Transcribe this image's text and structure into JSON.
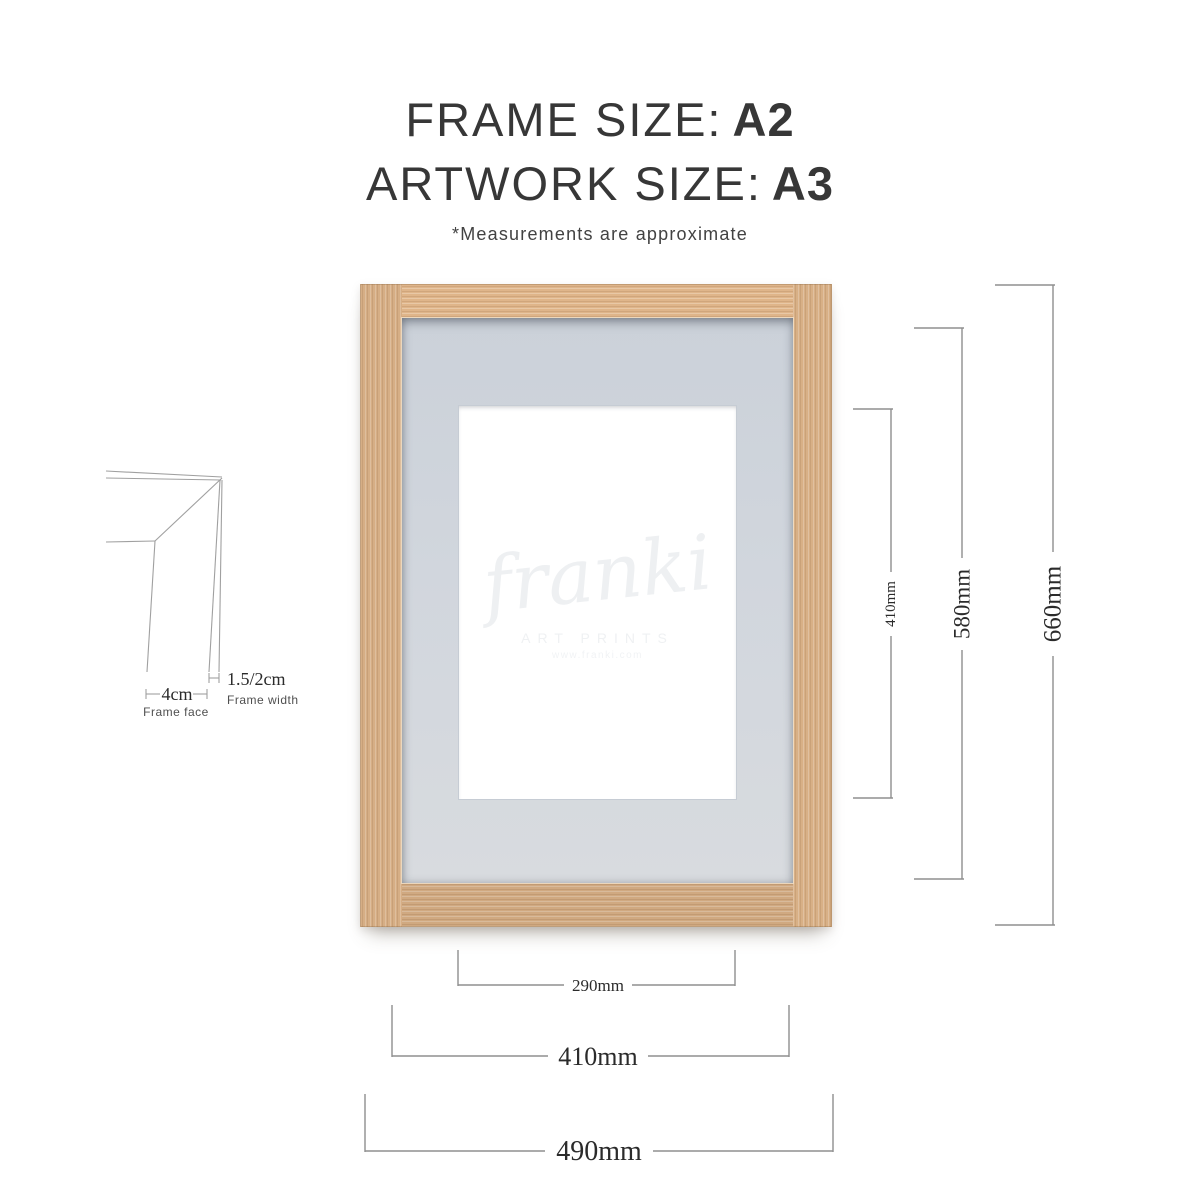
{
  "header": {
    "frame_size_label": "FRAME SIZE:",
    "frame_size_value": "A2",
    "artwork_size_label": "ARTWORK SIZE:",
    "artwork_size_value": "A3",
    "note": "*Measurements are approximate"
  },
  "frame_preview": {
    "wood_color": "#d6ae85",
    "mat_color": "#d1d6dd",
    "artwork_color": "#ffffff",
    "watermark": {
      "script": "franki",
      "subtitle": "ART PRINTS",
      "url": "www.franki.com"
    }
  },
  "dimensions": {
    "right": [
      {
        "id": "artwork-height",
        "label": "410mm"
      },
      {
        "id": "mount-opening-height",
        "label": "580mm"
      },
      {
        "id": "frame-height",
        "label": "660mm"
      }
    ],
    "bottom": [
      {
        "id": "artwork-width",
        "label": "290mm"
      },
      {
        "id": "mount-opening-width",
        "label": "410mm"
      },
      {
        "id": "frame-width",
        "label": "490mm"
      }
    ]
  },
  "profile_diagram": {
    "frame_width_value": "1.5/2cm",
    "frame_width_caption": "Frame width",
    "frame_face_value": "4cm",
    "frame_face_caption": "Frame face"
  }
}
